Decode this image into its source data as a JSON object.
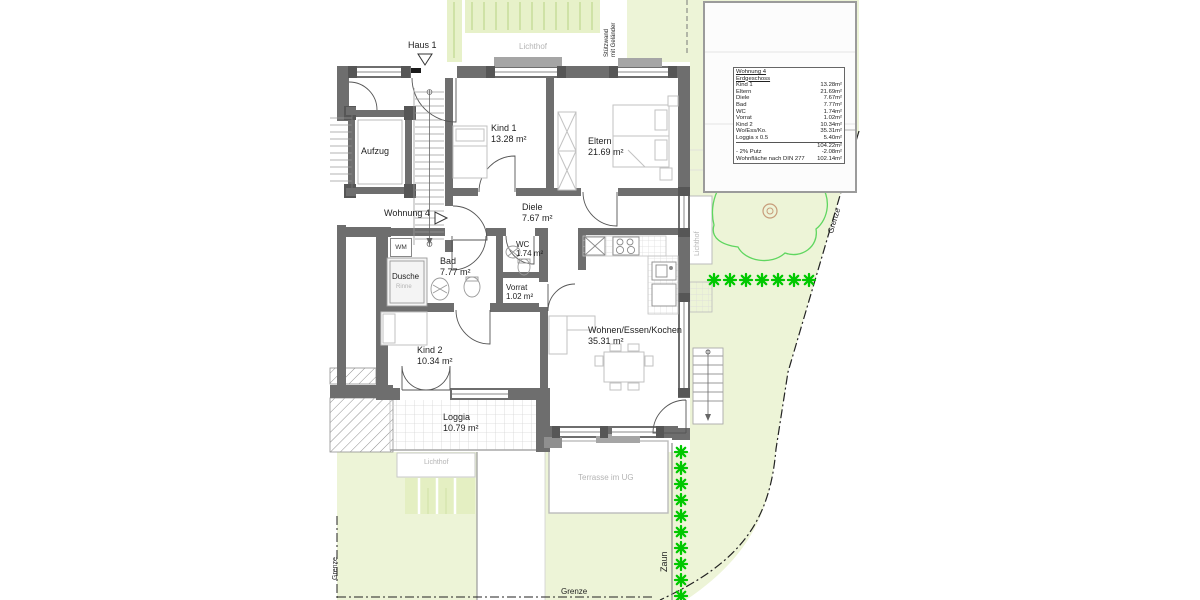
{
  "plan": {
    "haus_label": "Haus 1",
    "wohnung_label": "Wohnung 4",
    "lichthof_top": "Lichthof",
    "lichthof_right": "Lichthof",
    "lichthof_bottom": "Lichthof",
    "stuetzwand_line1": "Stützwand",
    "stuetzwand_line2": "mit Geländer",
    "terrasse": "Terrasse im UG",
    "zaun": "Zaun",
    "grenze_right": "Grenze",
    "grenze_left": "Grenze",
    "grenze_bottom": "Grenze",
    "aufzug": "Aufzug",
    "wm": "WM",
    "dusche": "Dusche",
    "dusche_sub": "Rinne"
  },
  "rooms": {
    "kind1": {
      "name": "Kind 1",
      "area": "13.28 m²"
    },
    "eltern": {
      "name": "Eltern",
      "area": "21.69 m²"
    },
    "diele": {
      "name": "Diele",
      "area": "7.67 m²"
    },
    "bad": {
      "name": "Bad",
      "area": "7.77 m²"
    },
    "wc": {
      "name": "WC",
      "area": "1.74 m²"
    },
    "vorrat": {
      "name": "Vorrat",
      "area": "1.02 m²"
    },
    "kind2": {
      "name": "Kind 2",
      "area": "10.34 m²"
    },
    "wohnen": {
      "name": "Wohnen/Essen/Kochen",
      "area": "35.31 m²"
    },
    "loggia": {
      "name": "Loggia",
      "area": "10.79 m²"
    }
  },
  "legend": {
    "title": "Wohnung 4",
    "subtitle": "Erdgeschoss",
    "rows": [
      {
        "label": "Kind 1",
        "value": "13.28m²"
      },
      {
        "label": "Eltern",
        "value": "21.69m²"
      },
      {
        "label": "Diele",
        "value": "7.67m²"
      },
      {
        "label": "Bad",
        "value": "7.77m²"
      },
      {
        "label": "WC",
        "value": "1.74m²"
      },
      {
        "label": "Vorrat",
        "value": "1.02m²"
      },
      {
        "label": "Kind 2",
        "value": "10.34m²"
      },
      {
        "label": "Wo/Ess/Ko.",
        "value": "35.31m²"
      },
      {
        "label": "Loggia x 0.5",
        "value": "5.40m²"
      }
    ],
    "sum": "104.22m²",
    "putz": {
      "label": "- 2% Putz",
      "value": "-2.08m²"
    },
    "total": {
      "label": "Wohnfläche nach DIN 277",
      "value": "102.14m²"
    }
  },
  "colors": {
    "garden": "#edf4d7",
    "hedge_line": "#cfe2a6",
    "wall": "#6e6e6e",
    "wall_dark": "#565656",
    "plant_green": "#00c800",
    "tree_outline": "#5fd65f",
    "trunk_brown": "#c79c7a",
    "gray_text": "#b4b4b4"
  }
}
